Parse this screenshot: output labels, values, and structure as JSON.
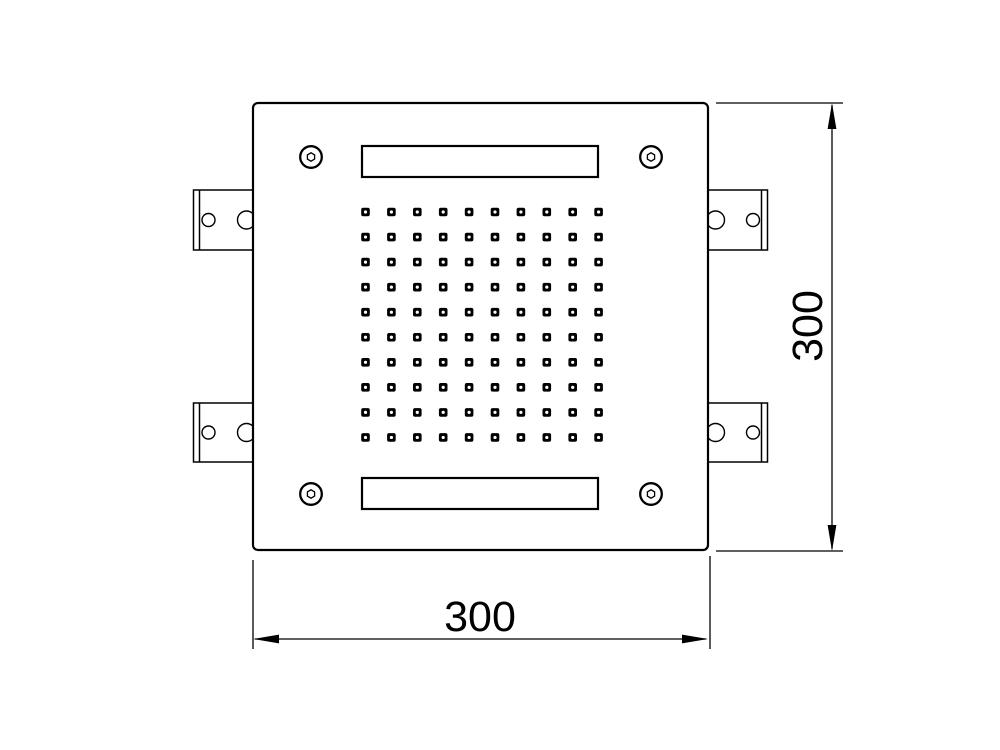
{
  "drawing": {
    "type": "technical-dimension-drawing",
    "view": "square-showerhead-face-top-view",
    "background_color": "#ffffff",
    "line_color": "#000000",
    "width_dimension": {
      "label": "300"
    },
    "height_dimension": {
      "label": "300"
    },
    "nozzle_grid": {
      "rows": 10,
      "cols": 10
    },
    "corner_screw_count": 4,
    "mounting_bracket_count": 4,
    "water_slot_count": 2
  }
}
